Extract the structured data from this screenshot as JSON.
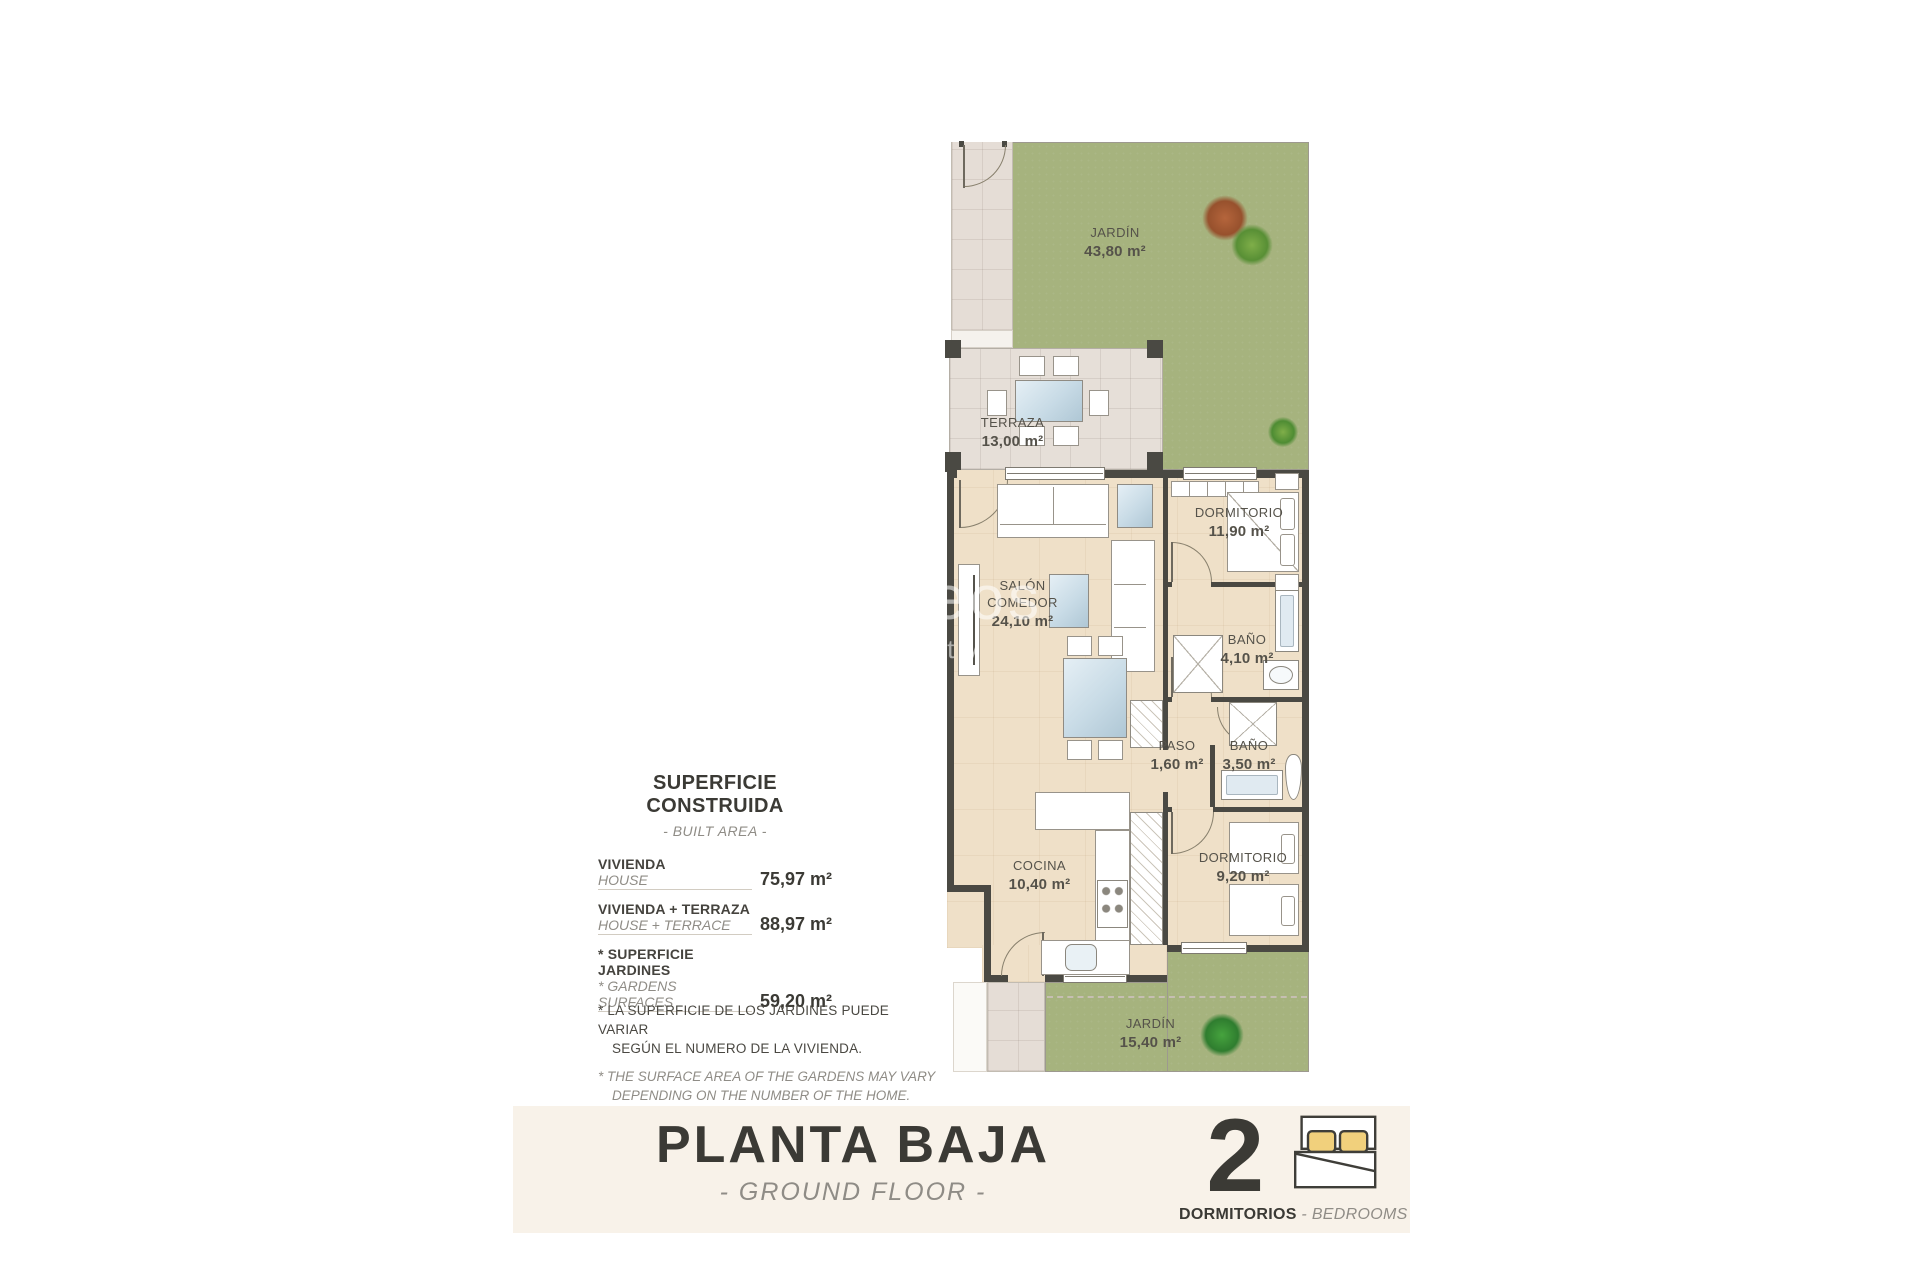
{
  "colors": {
    "garden_green": "#a6b37e",
    "interior_floor": "#efe0c8",
    "terrace_tile": "#e5ddd6",
    "wall_dark": "#4a4943",
    "banner_background": "#f8f2e9",
    "pillow_yellow": "#f1d07c"
  },
  "watermark": {
    "line1": "verseos",
    "line2": "property"
  },
  "floor_plan": {
    "labels": {
      "jardin_top": {
        "name": "JARDÍN",
        "area": "43,80 m²"
      },
      "terraza": {
        "name": "TERRAZA",
        "area": "13,00 m²"
      },
      "salon": {
        "name1": "SALÓN",
        "name2": "COMEDOR",
        "area": "24,10 m²"
      },
      "dormitorio1": {
        "name": "DORMITORIO",
        "area": "11,90 m²"
      },
      "bano1": {
        "name": "BAÑO",
        "area": "4,10 m²"
      },
      "paso": {
        "name": "PASO",
        "area": "1,60 m²"
      },
      "bano2": {
        "name": "BAÑO",
        "area": "3,50 m²"
      },
      "cocina": {
        "name": "COCINA",
        "area": "10,40 m²"
      },
      "dormitorio2": {
        "name": "DORMITORIO",
        "area": "9,20 m²"
      },
      "jardin_bottom": {
        "name": "JARDÍN",
        "area": "15,40 m²"
      }
    }
  },
  "info_panel": {
    "title": "SUPERFICIE CONSTRUIDA",
    "subtitle": "- BUILT AREA -",
    "rows": [
      {
        "label_es": "VIVIENDA",
        "label_en": "HOUSE",
        "value": "75,97 m²"
      },
      {
        "label_es": "VIVIENDA + TERRAZA",
        "label_en": "HOUSE + TERRACE",
        "value": "88,97 m²"
      },
      {
        "label_es": "* SUPERFICIE JARDINES",
        "label_en": "* GARDENS SURFACES",
        "value": "59,20 m²"
      }
    ],
    "footnote_es_line1": "* LA SUPERFICIE DE LOS JARDINES PUEDE VARIAR",
    "footnote_es_line2": "SEGÚN EL NUMERO DE LA VIVIENDA.",
    "footnote_en_line1": "* THE SURFACE AREA OF THE GARDENS MAY VARY",
    "footnote_en_line2": "DEPENDING ON THE NUMBER OF THE HOME."
  },
  "banner": {
    "title": "PLANTA BAJA",
    "subtitle": "- GROUND FLOOR -",
    "bedrooms_count": "2",
    "bedrooms_label_es": "DORMITORIOS",
    "bedrooms_label_sep": " - ",
    "bedrooms_label_en": "BEDROOMS"
  }
}
